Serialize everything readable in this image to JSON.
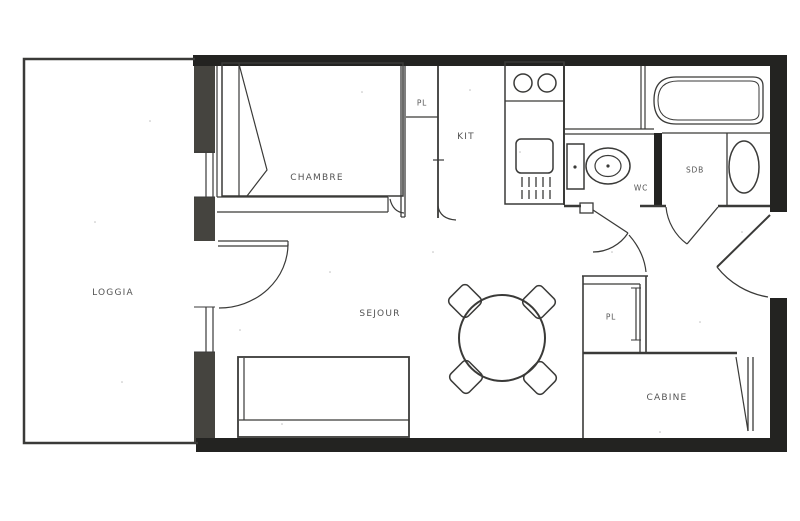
{
  "plan_type": "apartment-floor-plan",
  "colors": {
    "paper": "#ffffff",
    "ink": "#3a3a38",
    "wall": "#232321",
    "wallgrey": "#45443f",
    "label": "#3b3b3b"
  },
  "rooms": {
    "loggia": {
      "label": "LOGGIA"
    },
    "chambre": {
      "label": "CHAMBRE"
    },
    "kit": {
      "label": "KIT"
    },
    "pl_top": {
      "label": "PL"
    },
    "wc": {
      "label": "WC"
    },
    "sdb": {
      "label": "SDB"
    },
    "sejour": {
      "label": "SEJOUR"
    },
    "pl_hall": {
      "label": "PL"
    },
    "cabine": {
      "label": "CABINE"
    }
  },
  "fixtures": [
    "double-bed",
    "kitchen-hob-two-burners",
    "kitchen-sink-unit",
    "toilet",
    "bathtub",
    "washbasin",
    "sofa-bed",
    "round-dining-table",
    "four-chairs",
    "wardrobe-closets",
    "door-swings",
    "windows"
  ]
}
